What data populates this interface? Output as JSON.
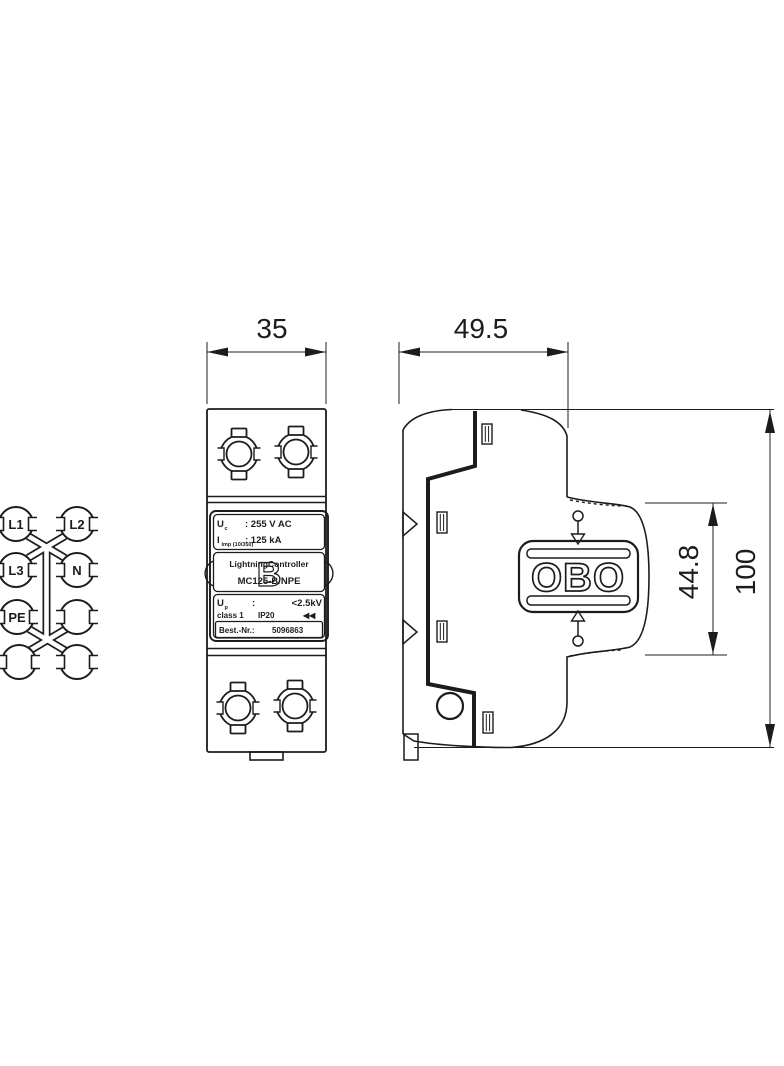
{
  "drawing": {
    "colors": {
      "background": "#ffffff",
      "line": "#1c1c1c"
    },
    "dimensions": {
      "front_width": "35",
      "side_depth": "49.5",
      "module_height": "44.8",
      "total_height": "100"
    },
    "schematic": {
      "terminals": [
        {
          "label": "L1"
        },
        {
          "label": "L2"
        },
        {
          "label": "L3"
        },
        {
          "label": "N"
        },
        {
          "label": "PE"
        }
      ]
    },
    "front_label": {
      "uc_symbol": "U",
      "uc_sub": "c",
      "uc_value": ":  255  V  AC",
      "iimp_symbol": "I",
      "iimp_sub": "imp (10/350)",
      "iimp_value": ":  125   kA",
      "brand": "LightningController",
      "logo_letter": "B",
      "model": "MC125-B/NPE",
      "up_symbol": "U",
      "up_sub": "p",
      "up_colon": ":",
      "up_value": "<2.5kV",
      "class_text": "class 1",
      "ip_rating": "IP20",
      "cert_mark": "◀◀",
      "order_label": "Best.-Nr.:",
      "order_number": "5096863"
    },
    "side_logo": "OBO"
  }
}
